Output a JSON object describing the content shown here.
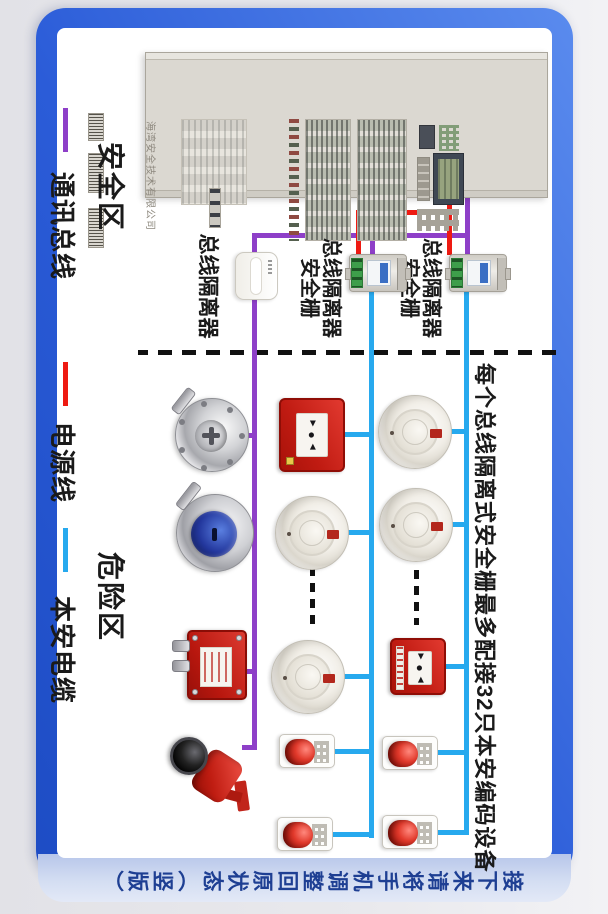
{
  "colors": {
    "comm_bus": "#8e3fc8",
    "power_line": "#ee1a12",
    "ia_cable": "#27a9ee",
    "separator": "#111111",
    "frame_1": "#5a8bee",
    "frame_2": "#2b5cd8",
    "hint_text": "#1e3f93"
  },
  "legend": {
    "items": [
      {
        "label": "通讯总线"
      },
      {
        "label": "电源线"
      },
      {
        "label": "本安电缆"
      }
    ]
  },
  "zones": {
    "safe_label": "安全区",
    "hazard_label": "危险区"
  },
  "panel": {
    "brand_text": "海湾安全技术有限公司"
  },
  "labels": {
    "isolator": "总线隔离器",
    "barrier_line1": "总线隔离器",
    "barrier_line2": "安全栅",
    "annotation": "每个总线隔离式安全栅最多配接32只本安编码设备",
    "rotate_hint": "接下来请将手机调整回原状态（竖版）"
  },
  "callpoint_glyphs": {
    "left": "►",
    "dot": "●",
    "right": "◄"
  }
}
